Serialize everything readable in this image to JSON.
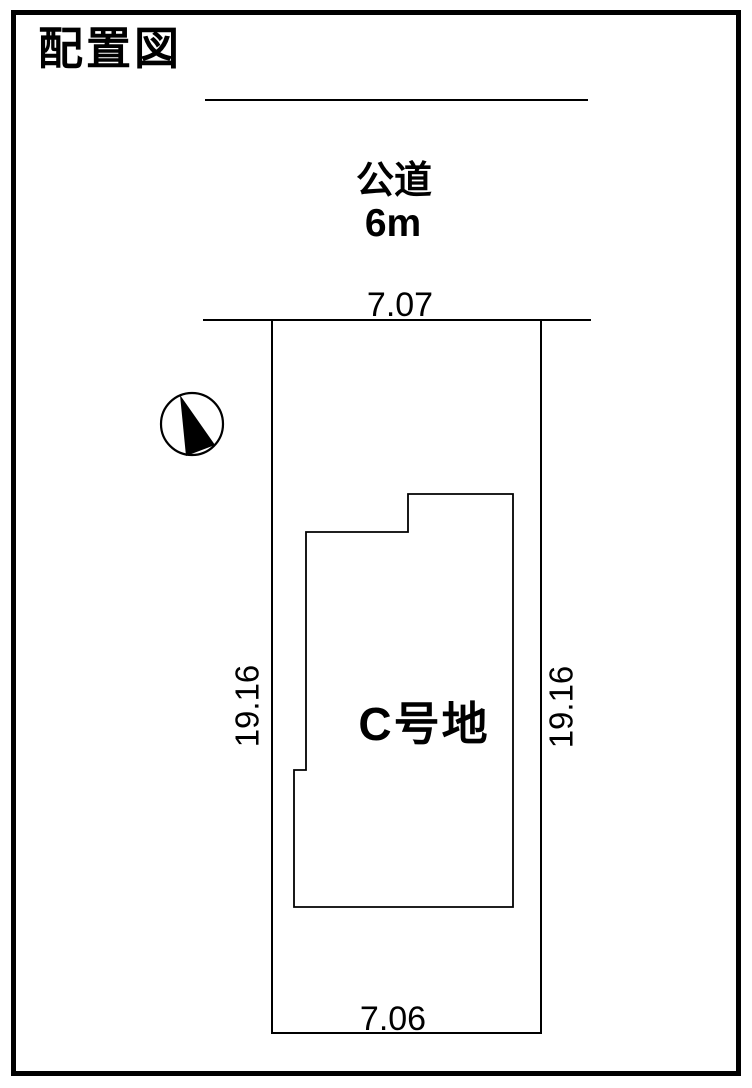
{
  "title": "配置図",
  "road": {
    "label": "公道",
    "width_label": "6m"
  },
  "plot": {
    "label": "C号地",
    "dimensions": {
      "top": "7.07",
      "bottom": "7.06",
      "left": "19.16",
      "right": "19.16"
    }
  },
  "compass": {
    "icon": "north-arrow"
  },
  "colors": {
    "line": "#000000",
    "background": "#ffffff",
    "text": "#000000"
  }
}
